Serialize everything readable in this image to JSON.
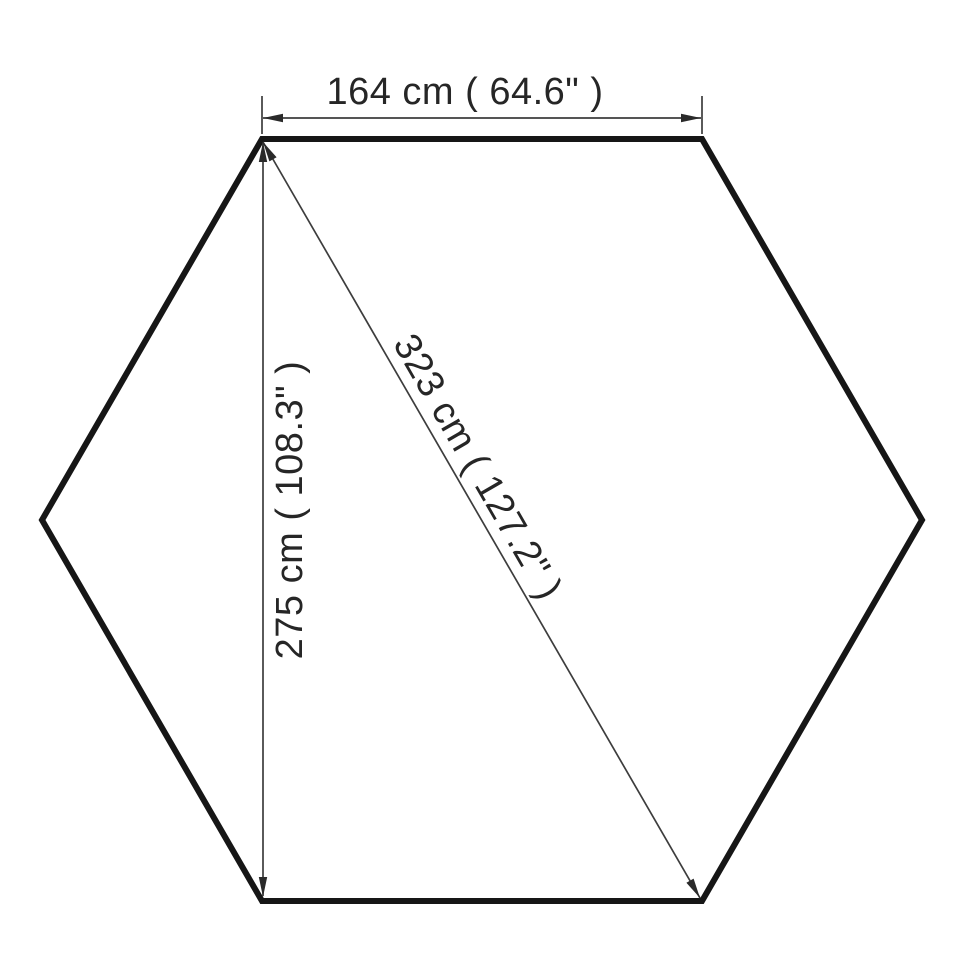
{
  "diagram": {
    "title": "hexagon-dimension-drawing",
    "shape": "regular-hexagon",
    "dimensions": [
      {
        "id": "top-width",
        "cm": 164,
        "inches": 64.6,
        "label": "164 cm ( 64.6\" )"
      },
      {
        "id": "diagonal",
        "cm": 323,
        "inches": 127.2,
        "label": "323 cm ( 127.2\" )"
      },
      {
        "id": "height",
        "cm": 275,
        "inches": 108.3,
        "label": "275 cm ( 108.3\" )"
      }
    ],
    "colors": {
      "background": "#ffffff",
      "outline": "#161616",
      "dimension_line": "#3d3d3d",
      "arrow": "#2a2a2a",
      "text": "#262626"
    }
  }
}
